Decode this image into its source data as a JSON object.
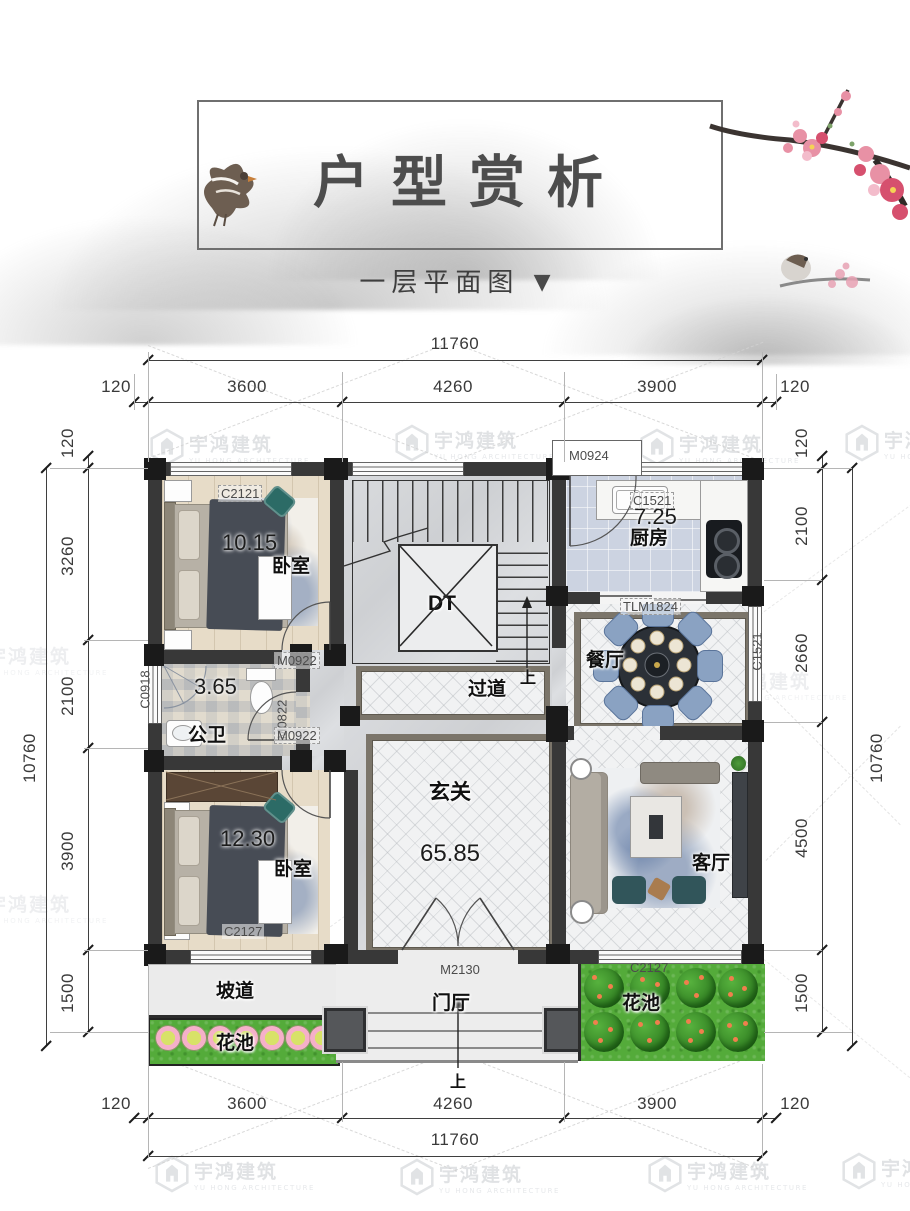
{
  "header": {
    "title": "户型赏析",
    "subtitle": "一层平面图",
    "subtitle_arrow": "▼"
  },
  "watermark": {
    "name": "宇鸿建筑",
    "subname": "YU HONG ARCHITECTURE"
  },
  "dims": {
    "top_overall": "11760",
    "top_segments": [
      "120",
      "3600",
      "4260",
      "3900",
      "120"
    ],
    "bottom_segments": [
      "120",
      "3600",
      "4260",
      "3900",
      "120"
    ],
    "bottom_overall": "11760",
    "left_overall": "10760",
    "left_segments": [
      "120",
      "3260",
      "2100",
      "3900",
      "1500"
    ],
    "right_overall": "10760",
    "right_segments": [
      "120",
      "2100",
      "2660",
      "4500",
      "1500"
    ]
  },
  "rooms": {
    "bedroom1": {
      "name": "卧室",
      "area": "10.15"
    },
    "kitchen": {
      "name": "厨房",
      "area": "7.25"
    },
    "dining": {
      "name": "餐厅"
    },
    "bathroom": {
      "name": "公卫",
      "area": "3.65"
    },
    "corridor": {
      "name": "过道"
    },
    "foyer": {
      "name": "玄关",
      "area": "65.85"
    },
    "bedroom2": {
      "name": "卧室",
      "area": "12.30"
    },
    "living": {
      "name": "客厅"
    },
    "ramp": {
      "name": "坡道"
    },
    "porch": {
      "name": "门厅"
    },
    "flowerbed_left": {
      "name": "花池"
    },
    "flowerbed_right": {
      "name": "花池"
    },
    "elevator": {
      "name": "DT"
    }
  },
  "openings": {
    "c2121": "C2121",
    "m0924": "M0924",
    "c1521_top": "C1521",
    "tlm1824": "TLM1824",
    "c1521_right": "C1521",
    "c0918": "C0918",
    "m0922_top": "M0922",
    "m0822": "M0822",
    "m0922_bottom": "M0922",
    "c2127_left": "C2127",
    "m2130": "M2130",
    "c2127_right": "C2127",
    "up": "上"
  },
  "colors": {
    "wall": "#383838",
    "grass": "#54ab3a",
    "wood_floor": "#e7dcc8",
    "kitchen_tile": "#ccd3e1",
    "chair_blue": "#8aa2c2",
    "rug_border": "#7b756a",
    "flower_pink": "#f5b0c9",
    "accent_teal": "#2c6b66"
  }
}
